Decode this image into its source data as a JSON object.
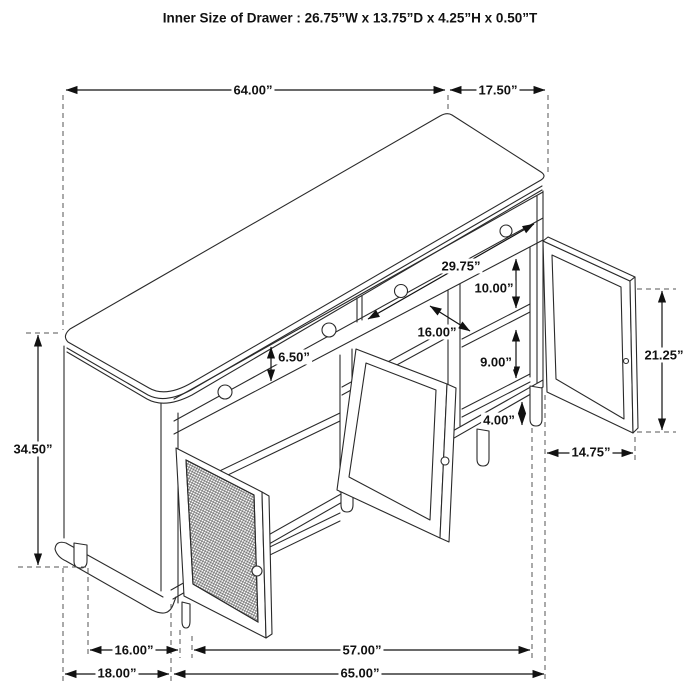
{
  "title": "Inner Size of Drawer : 26.75”W x 13.75”D x 4.25”H x 0.50”T",
  "diagram": {
    "type": "furniture-dimension-drawing",
    "subject": "sideboard cabinet with 2 drawers, cane mesh door and two open framed doors",
    "colors": {
      "line": "#2a2a2a",
      "dimension": "#111111",
      "background": "#ffffff"
    },
    "dims": [
      {
        "id": "top-width",
        "label": "64.00”"
      },
      {
        "id": "top-depth",
        "label": "17.50”"
      },
      {
        "id": "overall-height",
        "label": "34.50”"
      },
      {
        "id": "drawer-front-height",
        "label": "6.50”"
      },
      {
        "id": "drawer-width",
        "label": "29.75”"
      },
      {
        "id": "upper-shelf-clearance",
        "label": "10.00”"
      },
      {
        "id": "shelf-depth",
        "label": "16.00”"
      },
      {
        "id": "lower-shelf-clearance",
        "label": "9.00”"
      },
      {
        "id": "leg-height",
        "label": "4.00”"
      },
      {
        "id": "door-height",
        "label": "21.25”"
      },
      {
        "id": "door-width",
        "label": "14.75”"
      },
      {
        "id": "leg-spacing-side",
        "label": "16.00”"
      },
      {
        "id": "base-width",
        "label": "57.00”"
      },
      {
        "id": "side-depth",
        "label": "18.00”"
      },
      {
        "id": "overall-width",
        "label": "65.00”"
      }
    ]
  }
}
